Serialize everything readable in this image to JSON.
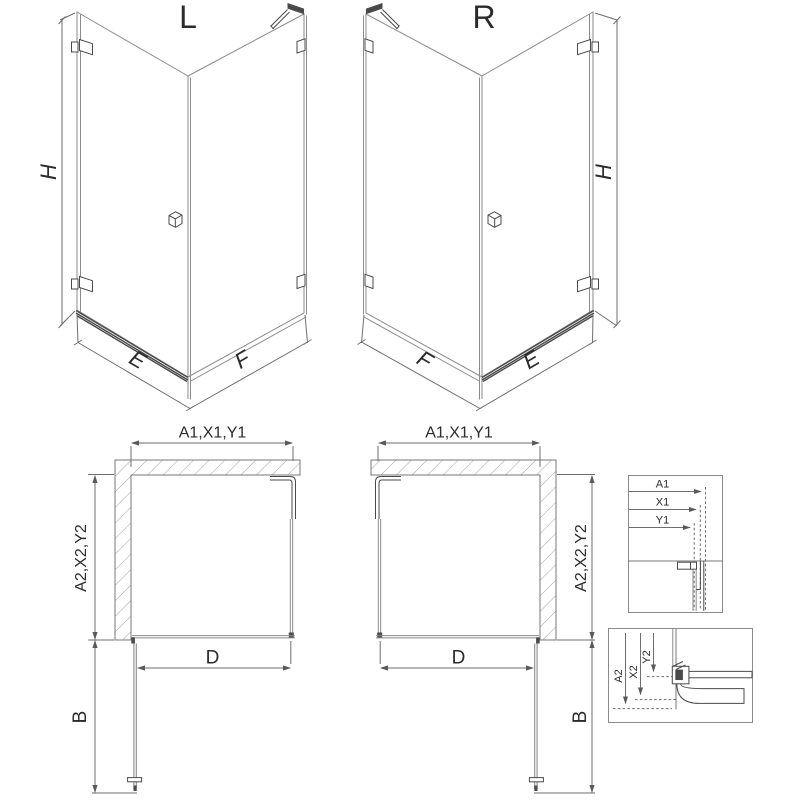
{
  "titles": {
    "left": "L",
    "right": "R"
  },
  "iso_left": {
    "height_label": "H",
    "front_width_label": "E",
    "side_width_label": "F"
  },
  "iso_right": {
    "height_label": "H",
    "side_width_label": "F",
    "front_width_label": "E"
  },
  "plan_left": {
    "top_dim_label": "A1,X1,Y1",
    "side_dim_label": "A2,X2,Y2",
    "door_width_label": "D",
    "door_swing_label": "B"
  },
  "plan_right": {
    "top_dim_label": "A1,X1,Y1",
    "side_dim_label": "A2,X2,Y2",
    "door_width_label": "D",
    "door_swing_label": "B"
  },
  "detail_top": {
    "a1": "A1",
    "x1": "X1",
    "y1": "Y1"
  },
  "detail_bottom": {
    "a2": "A2",
    "x2": "X2",
    "y2": "Y2"
  },
  "colors": {
    "ink": "#2b2b2b",
    "dim": "#6e6e6e",
    "glass": "#8b8b8b",
    "frame": "#4a4a4a",
    "wall": "#777777",
    "hatch": "#9a9a9a",
    "arrow": "#5a5a5a"
  }
}
